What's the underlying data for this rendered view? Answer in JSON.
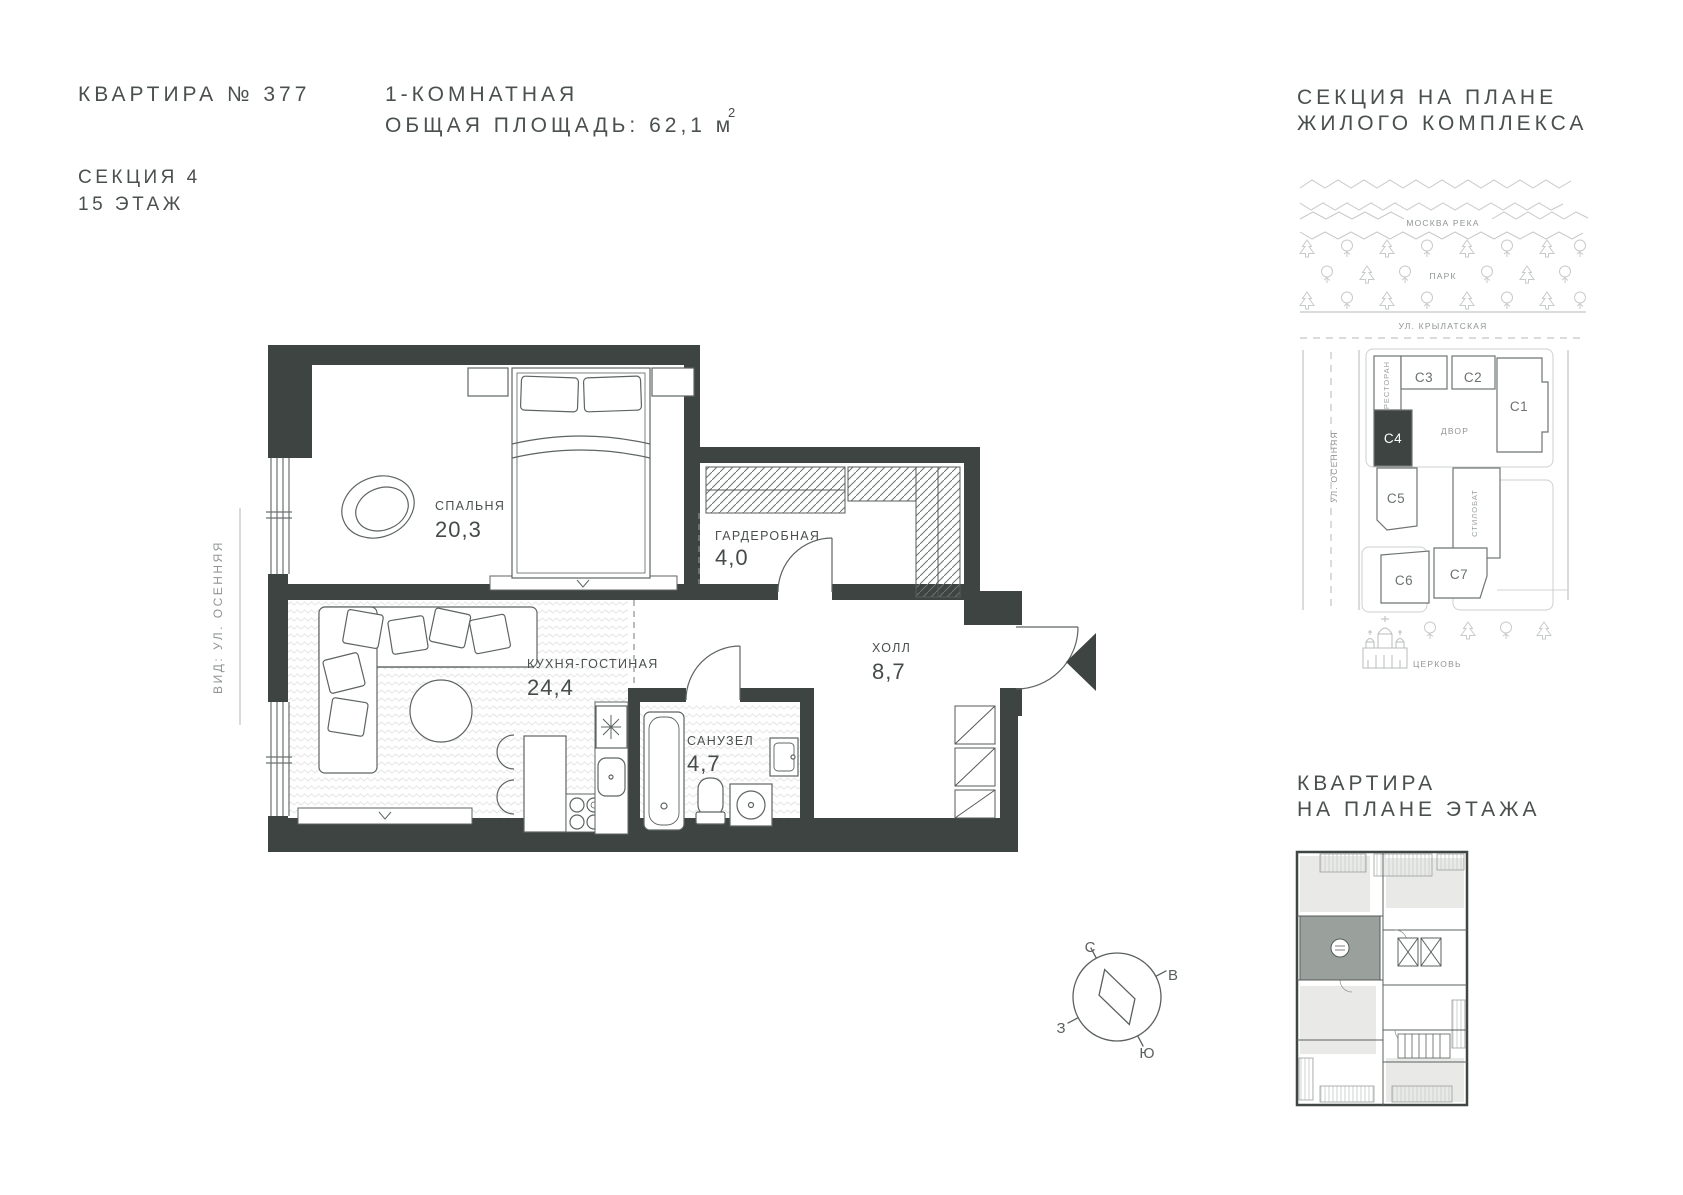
{
  "header": {
    "apartment_title": "КВАРТИРА № 377",
    "section_line": "СЕКЦИЯ 4",
    "floor_line": "15 ЭТАЖ",
    "type_line": "1-КОМНАТНАЯ",
    "area_line": "ОБЩАЯ ПЛОЩАДЬ: 62,1 м",
    "area_sup": "2"
  },
  "side_label": "ВИД: УЛ. ОСЕННЯЯ",
  "floor_plan": {
    "rooms": [
      {
        "name": "СПАЛЬНЯ",
        "area": "20,3"
      },
      {
        "name": "ГАРДЕРОБНАЯ",
        "area": "4,0"
      },
      {
        "name": "КУХНЯ-ГОСТИНАЯ",
        "area": "24,4"
      },
      {
        "name": "ХОЛЛ",
        "area": "8,7"
      },
      {
        "name": "САНУЗЕЛ",
        "area": "4,7"
      }
    ]
  },
  "site_plan": {
    "title_line1": "СЕКЦИЯ НА ПЛАНЕ",
    "title_line2": "ЖИЛОГО КОМПЛЕКСА",
    "river": "МОСКВА РЕКА",
    "park": "ПАРК",
    "street_top": "УЛ. КРЫЛАТСКАЯ",
    "street_left": "УЛ. ОСЕННЯЯ",
    "restaurant": "РЕСТОРАН",
    "courtyard": "ДВОР",
    "stylobate": "СТИЛОБАТ",
    "church": "ЦЕРКОВЬ",
    "sections": [
      {
        "label": "С1",
        "highlighted": false
      },
      {
        "label": "С2",
        "highlighted": false
      },
      {
        "label": "С3",
        "highlighted": false
      },
      {
        "label": "С4",
        "highlighted": true
      },
      {
        "label": "С5",
        "highlighted": false
      },
      {
        "label": "С6",
        "highlighted": false
      },
      {
        "label": "С7",
        "highlighted": false
      }
    ]
  },
  "floor_mini": {
    "title_line1": "КВАРТИРА",
    "title_line2": "НА ПЛАНЕ ЭТАЖА"
  },
  "compass": {
    "north": "С",
    "east": "В",
    "south": "Ю",
    "west": "З"
  },
  "colors": {
    "wall": "#3d4442",
    "text": "#4a504e",
    "muted": "#8f9592",
    "line": "#c4c8c6"
  }
}
